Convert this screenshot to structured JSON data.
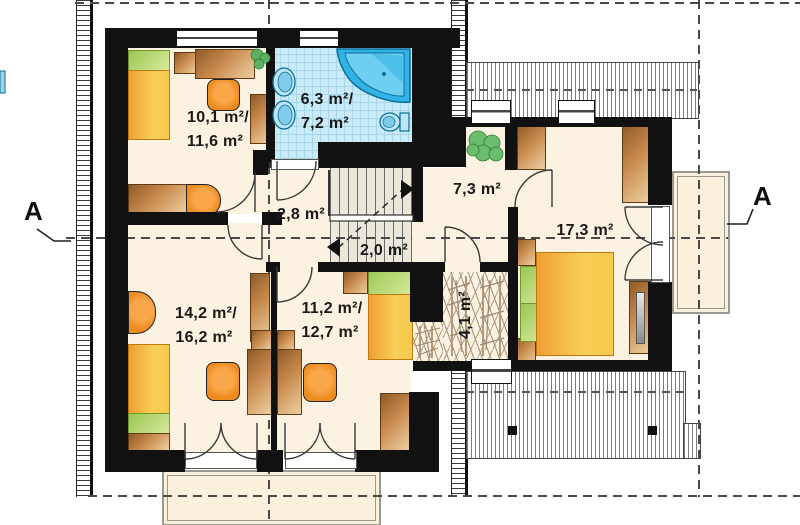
{
  "document": {
    "kind": "architectural-floor-plan"
  },
  "section_markers": {
    "left": "A",
    "right": "A"
  },
  "rooms": {
    "bedroom_top_left": {
      "line1": "10,1 m²/",
      "line2": "11,6 m²"
    },
    "bathroom": {
      "line1": "6,3 m²/",
      "line2": "7,2 m²"
    },
    "corridor": {
      "line1": "2,8 m²"
    },
    "stair_landing": {
      "line1": "2,0 m²"
    },
    "hall": {
      "line1": "7,3 m²"
    },
    "wardrobe_room": {
      "line1": "4,1 m²"
    },
    "bedroom_bottom_left": {
      "line1": "14,2 m²/",
      "line2": "16,2 m²"
    },
    "bedroom_bottom_middle": {
      "line1": "11,2 m²/",
      "line2": "12,7 m²"
    },
    "bedroom_right": {
      "line1": "17,3 m²"
    }
  },
  "colors": {
    "wall": "#111111",
    "floor": "#fcf2e1",
    "bath_tile": "#c9eaf6",
    "tub_blue": "#33b3e3",
    "furniture_orange": "#ee8c1f",
    "wood_light": "#eccfa2",
    "wood_dark": "#96602c",
    "bed_yellow": "#f7c94b",
    "pillow_green": "#b9da79",
    "plant_green": "#6bbd6e",
    "terrace": "#faf0dc",
    "stair_floor": "#ebe7da"
  },
  "fixtures": [
    "bed",
    "double-bed",
    "desk",
    "office-chair",
    "stool",
    "armchair",
    "wardrobe",
    "dresser",
    "nightstand",
    "bathtub",
    "washbasin",
    "toilet",
    "plant",
    "stairs",
    "hanger-rail",
    "mirror-wardrobe",
    "window",
    "door",
    "terrace",
    "balcony",
    "roof-slope"
  ]
}
